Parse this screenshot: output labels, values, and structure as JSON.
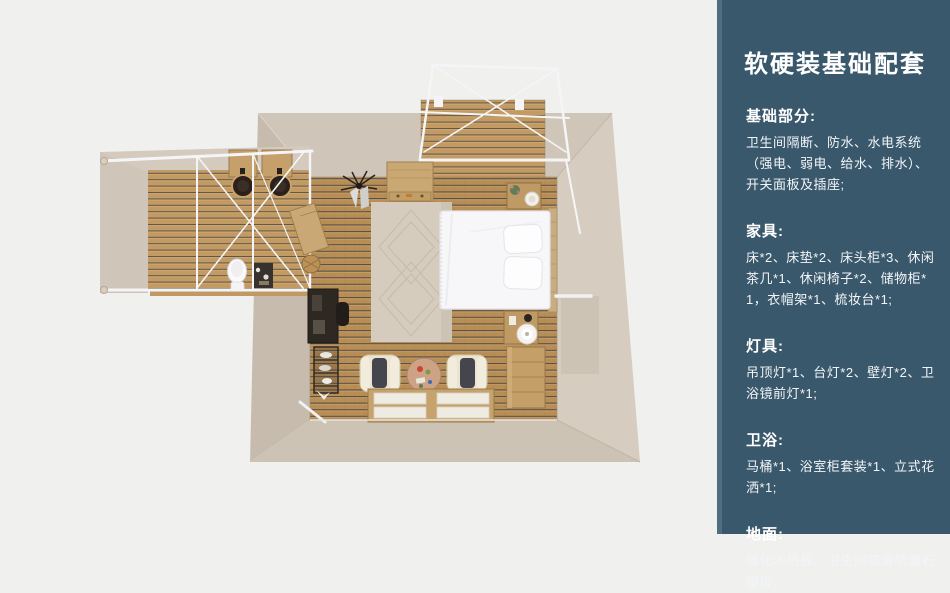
{
  "panel": {
    "title": "软硬装基础配套",
    "sections": [
      {
        "heading": "基础部分:",
        "body": "卫生间隔断、防水、水电系统（强电、弱电、给水、排水）、开关面板及插座;"
      },
      {
        "heading": "家具:",
        "body": "床*2、床垫*2、床头柜*3、休闲茶几*1、休闲椅子*2、储物柜*1，衣帽架*1、梳妆台*1;"
      },
      {
        "heading": "灯具:",
        "body": "吊顶灯*1、台灯*2、壁灯*2、卫浴镜前灯*1;"
      },
      {
        "heading": "卫浴:",
        "body": "马桶*1、浴室柜套装*1、立式花洒*1;"
      },
      {
        "heading": "地面:",
        "body": "强化木地板、卫生间防滑防潮石塑板;"
      }
    ],
    "colors": {
      "panel_bg": "#3a586b",
      "panel_edge": "#506e82",
      "text": "#ffffff"
    }
  },
  "floorplan": {
    "colors": {
      "background": "#f0f0ef",
      "wall_top": "#cfc6b9",
      "wall_right": "#d6cdc0",
      "wall_bottom": "#cdc3b5",
      "wall_left": "#c6bbac",
      "wood_dark_stripe": "#544e49",
      "wood_base": "#b88e55",
      "rug": "#d5ccbe",
      "bed": "#f7f7f9",
      "frame_white": "#f5f5f7",
      "furniture_wood": "#c49f68",
      "furniture_dark": "#2e2823",
      "armchair_cream": "#eae4d1"
    },
    "items": [
      "terrace-deck",
      "terrace-frame",
      "bathroom-deck",
      "bathroom-frame",
      "twin-sinks",
      "toilet",
      "bathroom-cabinet",
      "ceiling-lamp",
      "storage-cabinet",
      "rug",
      "double-bed",
      "pillows",
      "headboard",
      "nightstand-top",
      "nightstand-bottom",
      "table-lamp",
      "dresser",
      "vanity-desk",
      "coat-rack-shelf",
      "leisure-chair-left",
      "leisure-chair-right",
      "tea-table",
      "floor-windows",
      "wall-lamp"
    ]
  }
}
